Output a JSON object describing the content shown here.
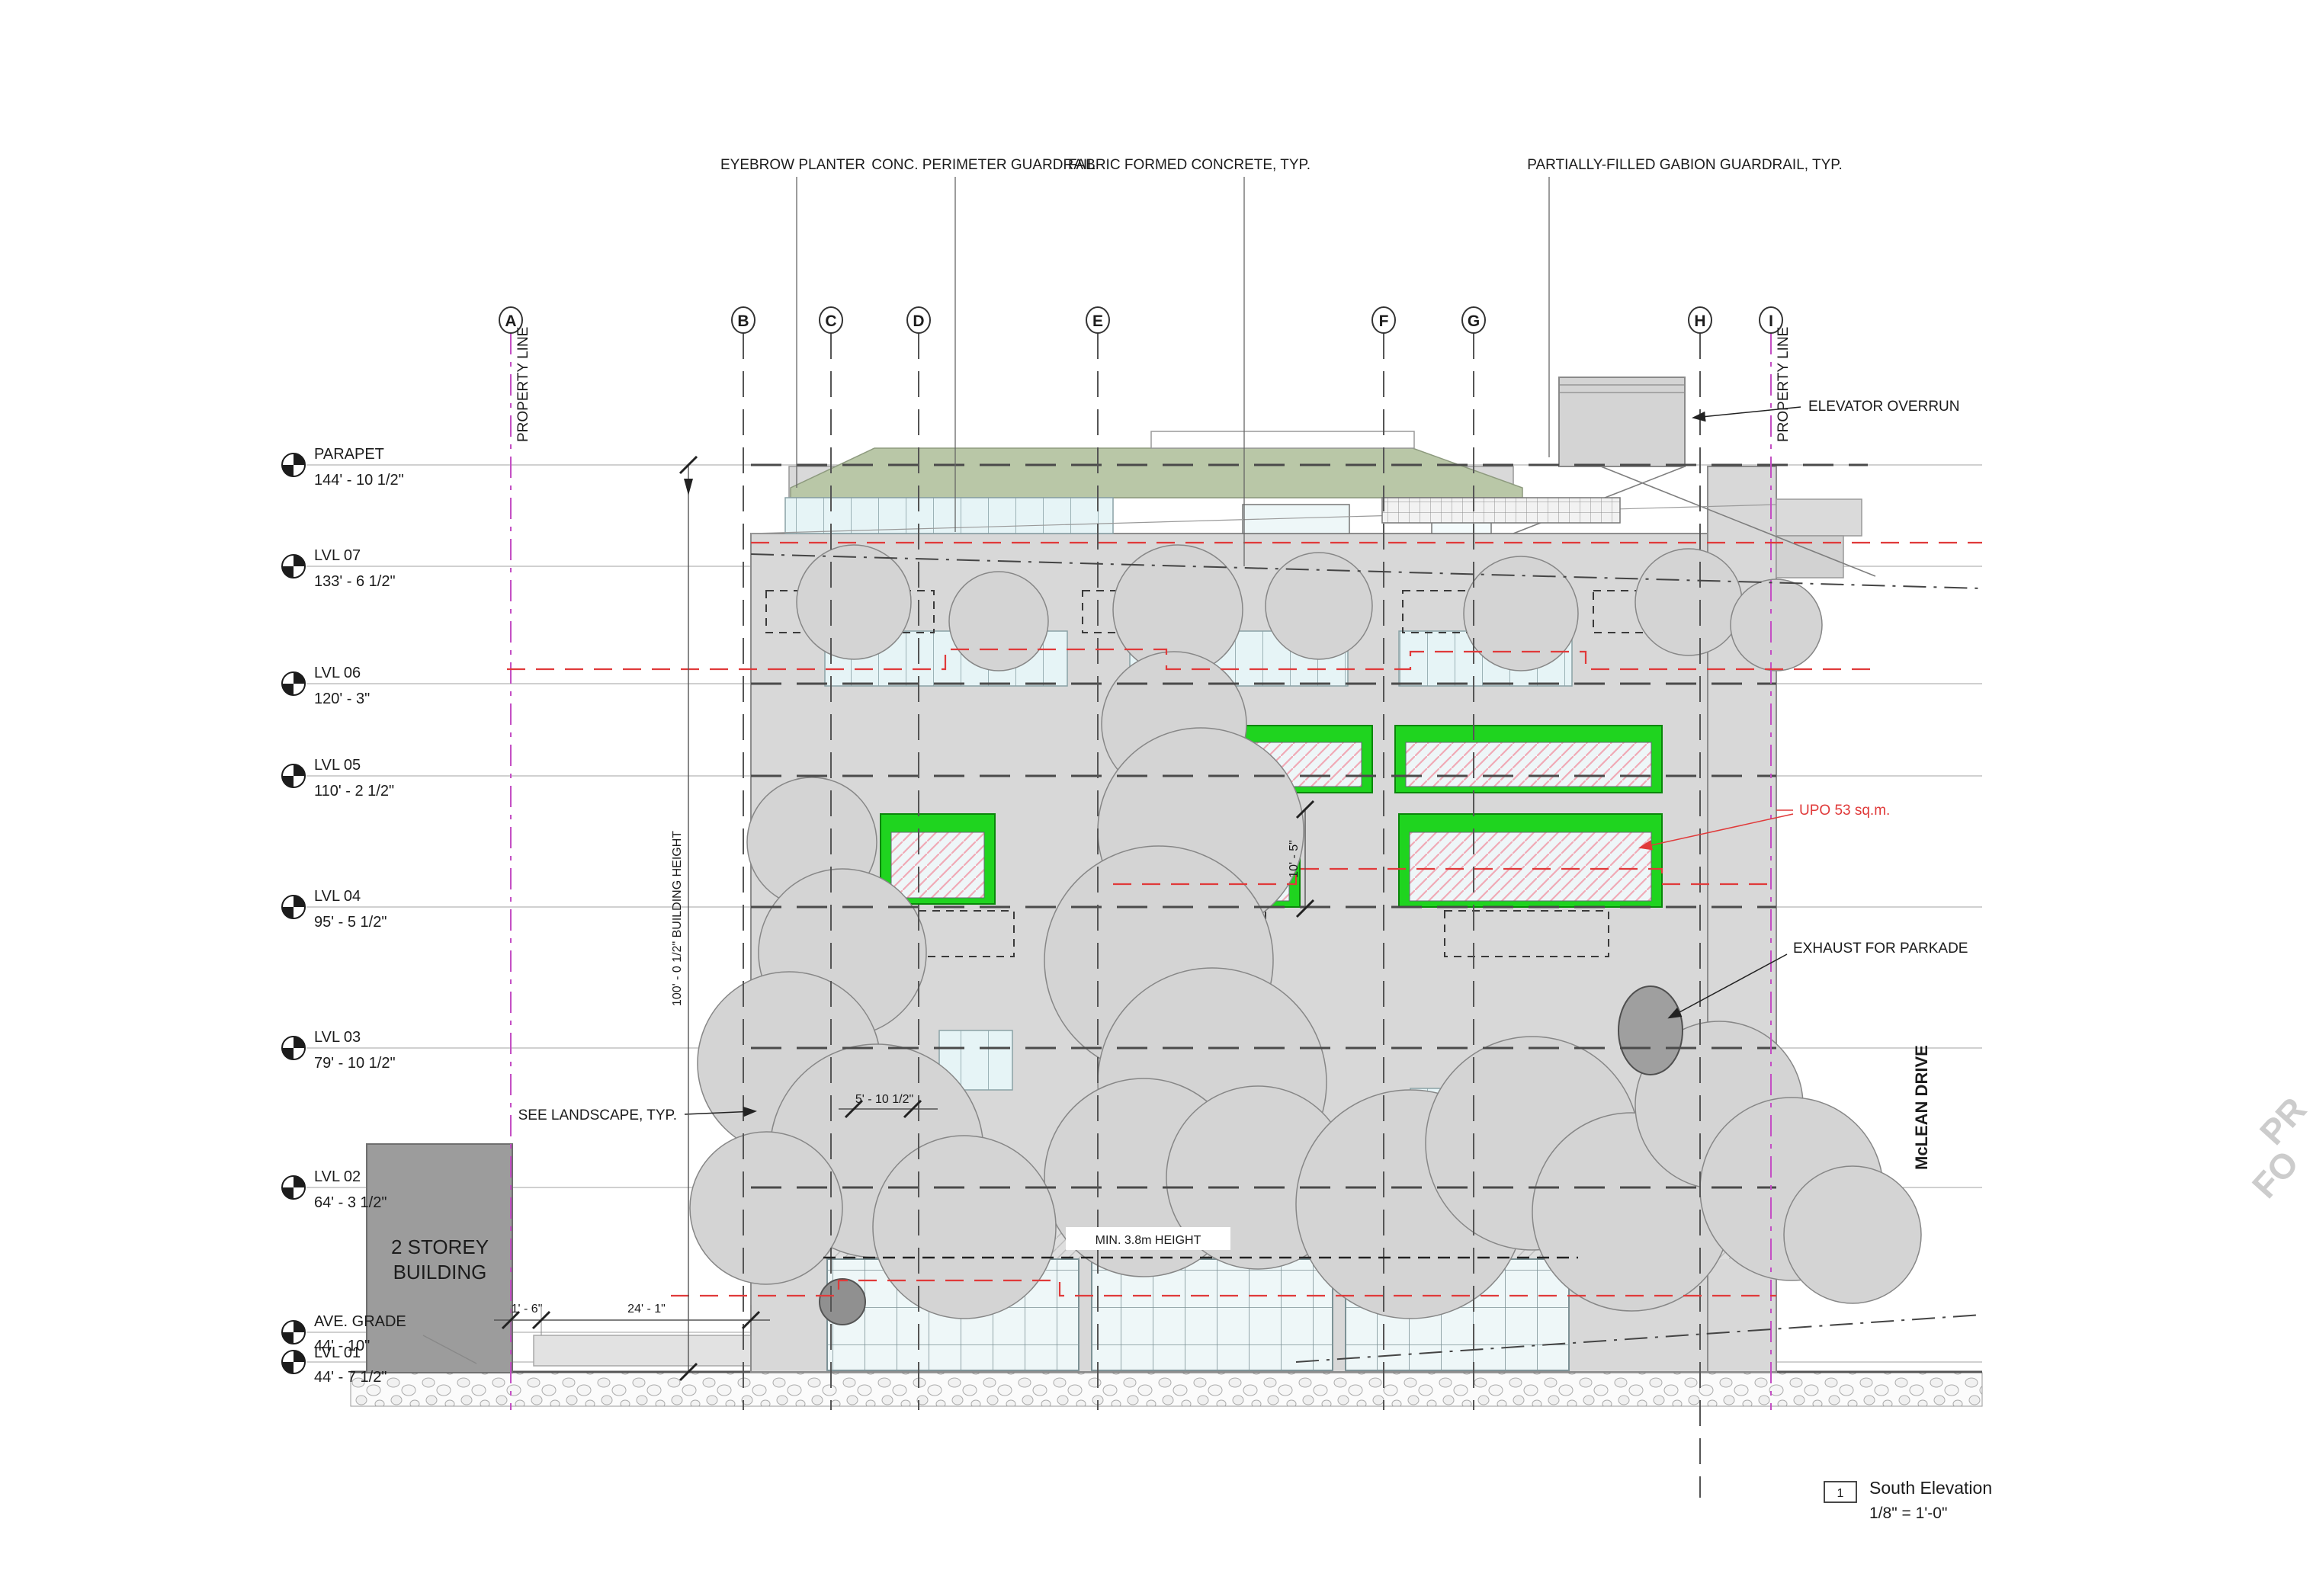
{
  "drawing": {
    "discipline": "architectural-elevation",
    "sheet_note": "South building elevation with grid lines, level datums and annotations"
  },
  "title_block": {
    "number": "1",
    "title": "South Elevation",
    "scale": "1/8\" = 1'-0\""
  },
  "top_annotations": [
    {
      "label": "EYEBROW PLANTER"
    },
    {
      "label": "CONC. PERIMETER GUARDRAIL"
    },
    {
      "label": "FABRIC FORMED CONCRETE, TYP."
    },
    {
      "label": "PARTIALLY-FILLED GABION GUARDRAIL, TYP."
    }
  ],
  "grid_bubbles": [
    {
      "label": "A"
    },
    {
      "label": "B"
    },
    {
      "label": "C"
    },
    {
      "label": "D"
    },
    {
      "label": "E"
    },
    {
      "label": "F"
    },
    {
      "label": "G"
    },
    {
      "label": "H"
    },
    {
      "label": "I"
    }
  ],
  "property_line": {
    "label_left": "PROPERTY LINE",
    "label_right": "PROPERTY LINE"
  },
  "levels": [
    {
      "name": "PARAPET",
      "elevation": "144' - 10 1/2\""
    },
    {
      "name": "LVL 07",
      "elevation": "133' - 6 1/2\""
    },
    {
      "name": "LVL 06",
      "elevation": "120' - 3\""
    },
    {
      "name": "LVL 05",
      "elevation": "110' - 2 1/2\""
    },
    {
      "name": "LVL 04",
      "elevation": "95' - 5 1/2\""
    },
    {
      "name": "LVL 03",
      "elevation": "79' - 10 1/2\""
    },
    {
      "name": "LVL 02",
      "elevation": "64' - 3 1/2\""
    },
    {
      "name": "AVE. GRADE",
      "elevation": "44' - 10\""
    },
    {
      "name": "LVL 01",
      "elevation": "44' - 7 1/2\""
    }
  ],
  "annotations": {
    "elevator_overrun": "ELEVATOR OVERRUN",
    "exhaust_parkade": "EXHAUST FOR PARKADE",
    "upo_area": "UPO 53 sq.m.",
    "see_landscape": "SEE LANDSCAPE, TYP.",
    "min_height": "MIN. 3.8m HEIGHT",
    "street_name": "McLEAN DRIVE",
    "neighbour_line1": "2 STOREY",
    "neighbour_line2": "BUILDING"
  },
  "dimensions": {
    "building_height": "100' - 0 1/2\"   BUILDING HEIGHT",
    "setback_24": "24' - 1\"",
    "setback_1_6": "1' - 6\"",
    "dim_5_10": "5' - 10 1/2\"",
    "dim_10_5": "10' - 5\""
  },
  "watermark": {
    "line1": "PR",
    "line2": "FO"
  },
  "colors": {
    "facade_gray": "#d8d8d8",
    "tree_gray": "#d4d4d4",
    "glazing_blue": "#e6f4f6",
    "upo_green": "#1fd41f",
    "annotation_red": "#e03a3a",
    "property_magenta": "#c44fc4",
    "green_roof": "#b9c7a7",
    "neighbour_gray": "#9c9c9c"
  }
}
